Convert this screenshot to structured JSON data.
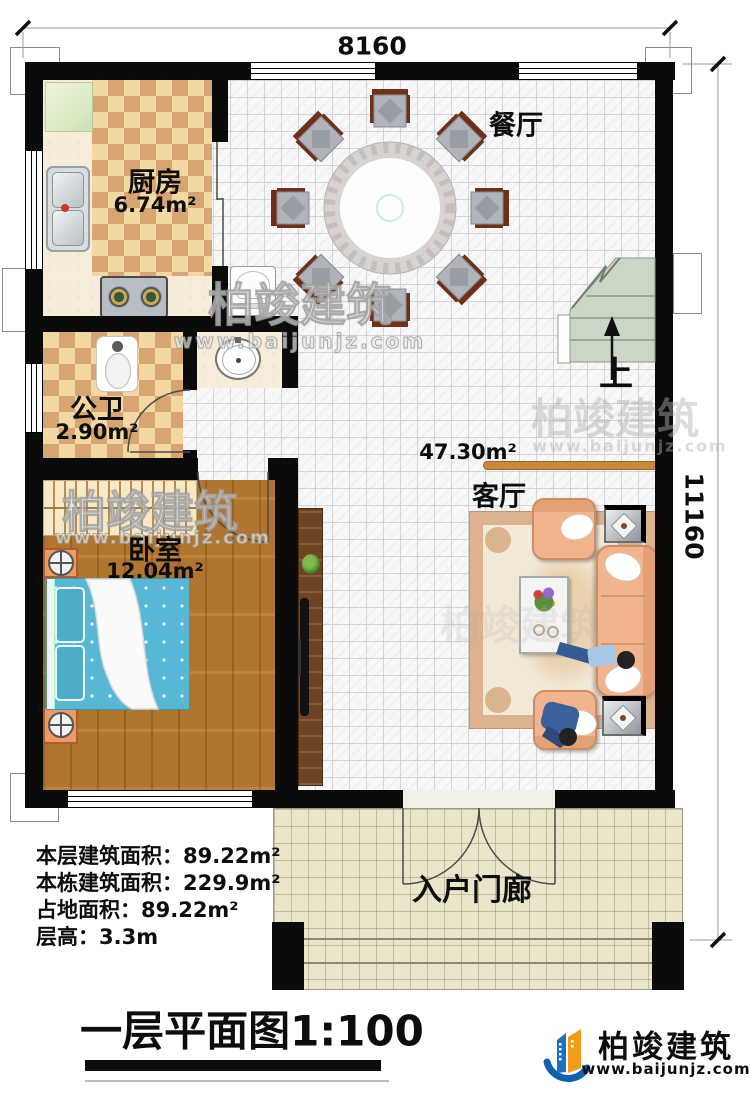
{
  "dimensions": {
    "top": "8160",
    "right": "11160"
  },
  "rooms": {
    "kitchen": {
      "name": "厨房",
      "area": "6.74m²"
    },
    "dining": {
      "name": "餐厅"
    },
    "bathroom": {
      "name": "公卫",
      "area": "2.90m²"
    },
    "bedroom": {
      "name": "卧室",
      "area": "12.04m²"
    },
    "living": {
      "name": "客厅",
      "area": "47.30m²"
    },
    "porch": {
      "name": "入户门廊"
    },
    "stairs": {
      "up_label": "上"
    }
  },
  "info_block": {
    "lines": [
      "本层建筑面积：89.22m²",
      "本栋建筑面积：229.9m²",
      "占地面积：89.22m²",
      "层高：3.3m"
    ]
  },
  "title": {
    "main": "一层平面图",
    "scale": "1:100"
  },
  "brand": {
    "name": "柏竣建筑",
    "url": "www.baijunjz.com"
  },
  "watermark": {
    "name": "柏竣建筑",
    "url": "www.baijunjz.com"
  }
}
